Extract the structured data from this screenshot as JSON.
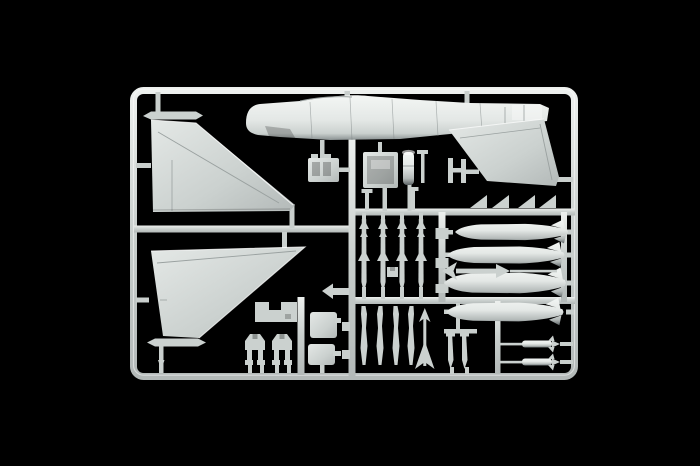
{
  "scene": {
    "kind": "photograph",
    "subject": "injection-molded plastic model kit sprue (aircraft parts frame) on black background",
    "sprue_color_name": "light grey styrene",
    "background_name": "black",
    "frame": {
      "left": 130,
      "top": 87,
      "right": 578,
      "bottom": 380,
      "corner_radius": 10,
      "bar_thickness": 7
    }
  },
  "colors": {
    "background": "#000000",
    "plastic_bright": "#f3f6f4",
    "plastic_light": "#e4e8e6",
    "plastic_base": "#cbd1cf",
    "plastic_mid": "#b3b9b8",
    "plastic_shadow": "#8b9293",
    "plastic_dark": "#5d6466",
    "runner": "#c9cfcd",
    "runner_highlight": "#edf0ee",
    "panel_line": "#9aa1a0",
    "recess_dark": "#757c7d"
  },
  "parts": [
    {
      "name": "fuselage-half",
      "count": 1
    },
    {
      "name": "delta-wing",
      "count": 2
    },
    {
      "name": "tailplane-bar",
      "count": 2
    },
    {
      "name": "swept-rudder-fin",
      "count": 1
    },
    {
      "name": "drop-tank",
      "count": 4
    },
    {
      "name": "air-to-air-missile-vertical",
      "count": 4
    },
    {
      "name": "small-fin-tab",
      "count": 4
    },
    {
      "name": "slim-pylon",
      "count": 4
    },
    {
      "name": "rocket-horizontal",
      "count": 1
    },
    {
      "name": "dart-missile",
      "count": 1
    },
    {
      "name": "missile-horizontal",
      "count": 2
    },
    {
      "name": "landing-gear-strut",
      "count": 2
    },
    {
      "name": "notched-bulkhead",
      "count": 1
    },
    {
      "name": "access-panel",
      "count": 2
    },
    {
      "name": "arrow-clip",
      "count": 1
    },
    {
      "name": "ejection-seat-box",
      "count": 1
    },
    {
      "name": "cockpit-tub",
      "count": 1
    },
    {
      "name": "cylinder-part",
      "count": 1
    },
    {
      "name": "pin-part",
      "count": 2
    },
    {
      "name": "h-bracket",
      "count": 1
    },
    {
      "name": "blade-part",
      "count": 2
    }
  ]
}
